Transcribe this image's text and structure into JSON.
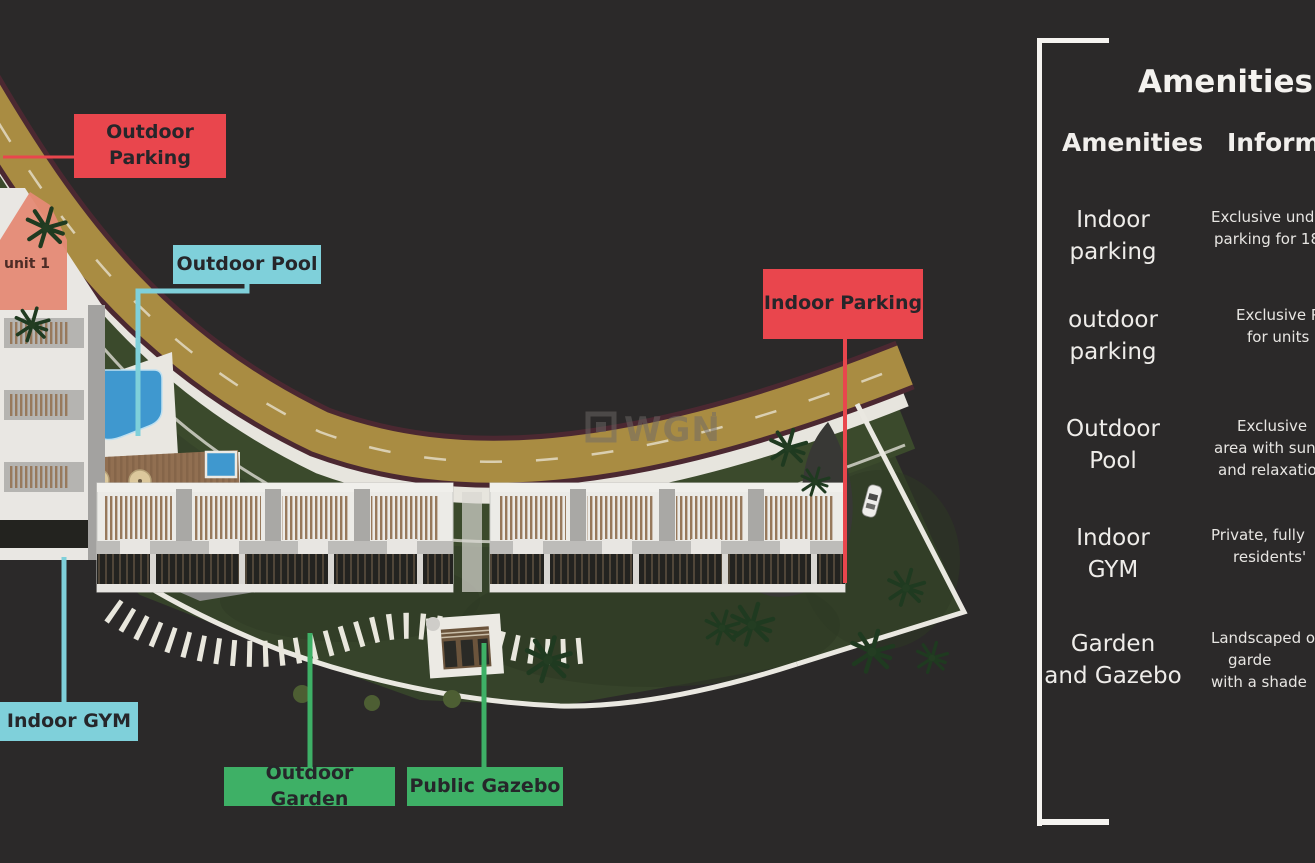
{
  "site_plan": {
    "watermark_text": "WGN",
    "unit_label": "unit 1",
    "colors": {
      "background": "#2b2929",
      "callout_red": "#e9464d",
      "callout_cyan": "#7fd0da",
      "callout_green": "#3eb066",
      "road_gold": "#a98c42",
      "lawn_green": "#36432a",
      "pool_blue": "#3f98cf"
    },
    "callouts": {
      "outdoor_parking": {
        "label": "Outdoor Parking",
        "color": "#e9464d"
      },
      "outdoor_pool": {
        "label": "Outdoor Pool",
        "color": "#7fd0da"
      },
      "indoor_parking": {
        "label": "Indoor Parking",
        "color": "#e9464d"
      },
      "indoor_gym": {
        "label": "Indoor GYM",
        "color": "#7fd0da"
      },
      "outdoor_garden": {
        "label": "Outdoor Garden",
        "color": "#3eb066"
      },
      "public_gazebo": {
        "label": "Public Gazebo",
        "color": "#3eb066"
      }
    }
  },
  "amenities_panel": {
    "title": "Amenities",
    "col_amenities": "Amenities",
    "col_information": "Information",
    "rows": [
      {
        "name": [
          "Indoor",
          "parking"
        ],
        "info": [
          "Exclusive und",
          "parking for 18"
        ]
      },
      {
        "name": [
          "outdoor",
          "parking"
        ],
        "info": [
          "Exclusive P",
          "for units"
        ]
      },
      {
        "name": [
          "Outdoor",
          "Pool"
        ],
        "info": [
          "Exclusive",
          "area with sun",
          "and relaxatio"
        ]
      },
      {
        "name": [
          "Indoor",
          "GYM"
        ],
        "info": [
          "Private, fully",
          "residents'"
        ]
      },
      {
        "name": [
          "Garden",
          "and Gazebo"
        ],
        "info": [
          "Landscaped o",
          "garde",
          "with a shade"
        ]
      }
    ]
  }
}
